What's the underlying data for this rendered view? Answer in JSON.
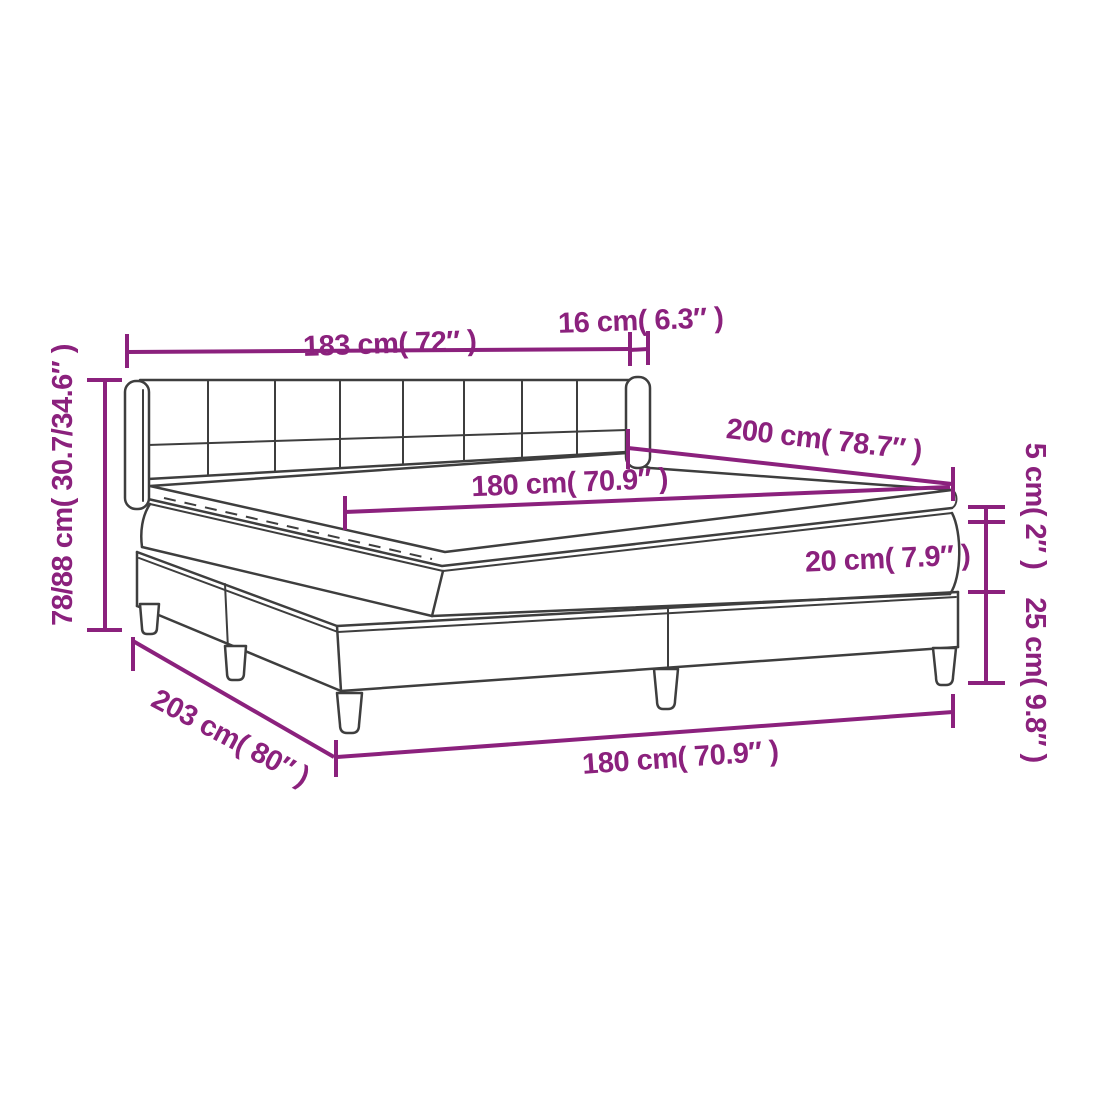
{
  "diagram": {
    "title": "box-spring-bed-dimension-diagram",
    "colors": {
      "dimension_annotation": "#8b217d",
      "bed_outline": "#3e3e3e",
      "background": "#ffffff"
    },
    "labels": {
      "headboard_width": "183 cm( 72″ )",
      "wing_thickness": "16 cm( 6.3″ )",
      "bed_length": "200 cm( 78.7″ )",
      "mattress_width": "180 cm( 70.9″ )",
      "topper_thickness": "5 cm( 2″ )",
      "mattress_thickness": "20 cm( 7.9″ )",
      "base_height": "25 cm( 9.8″ )",
      "total_height": "78/88 cm( 30.7/34.6″ )",
      "frame_length": "203 cm( 80″ )",
      "base_width": "180 cm( 70.9″ )"
    }
  }
}
